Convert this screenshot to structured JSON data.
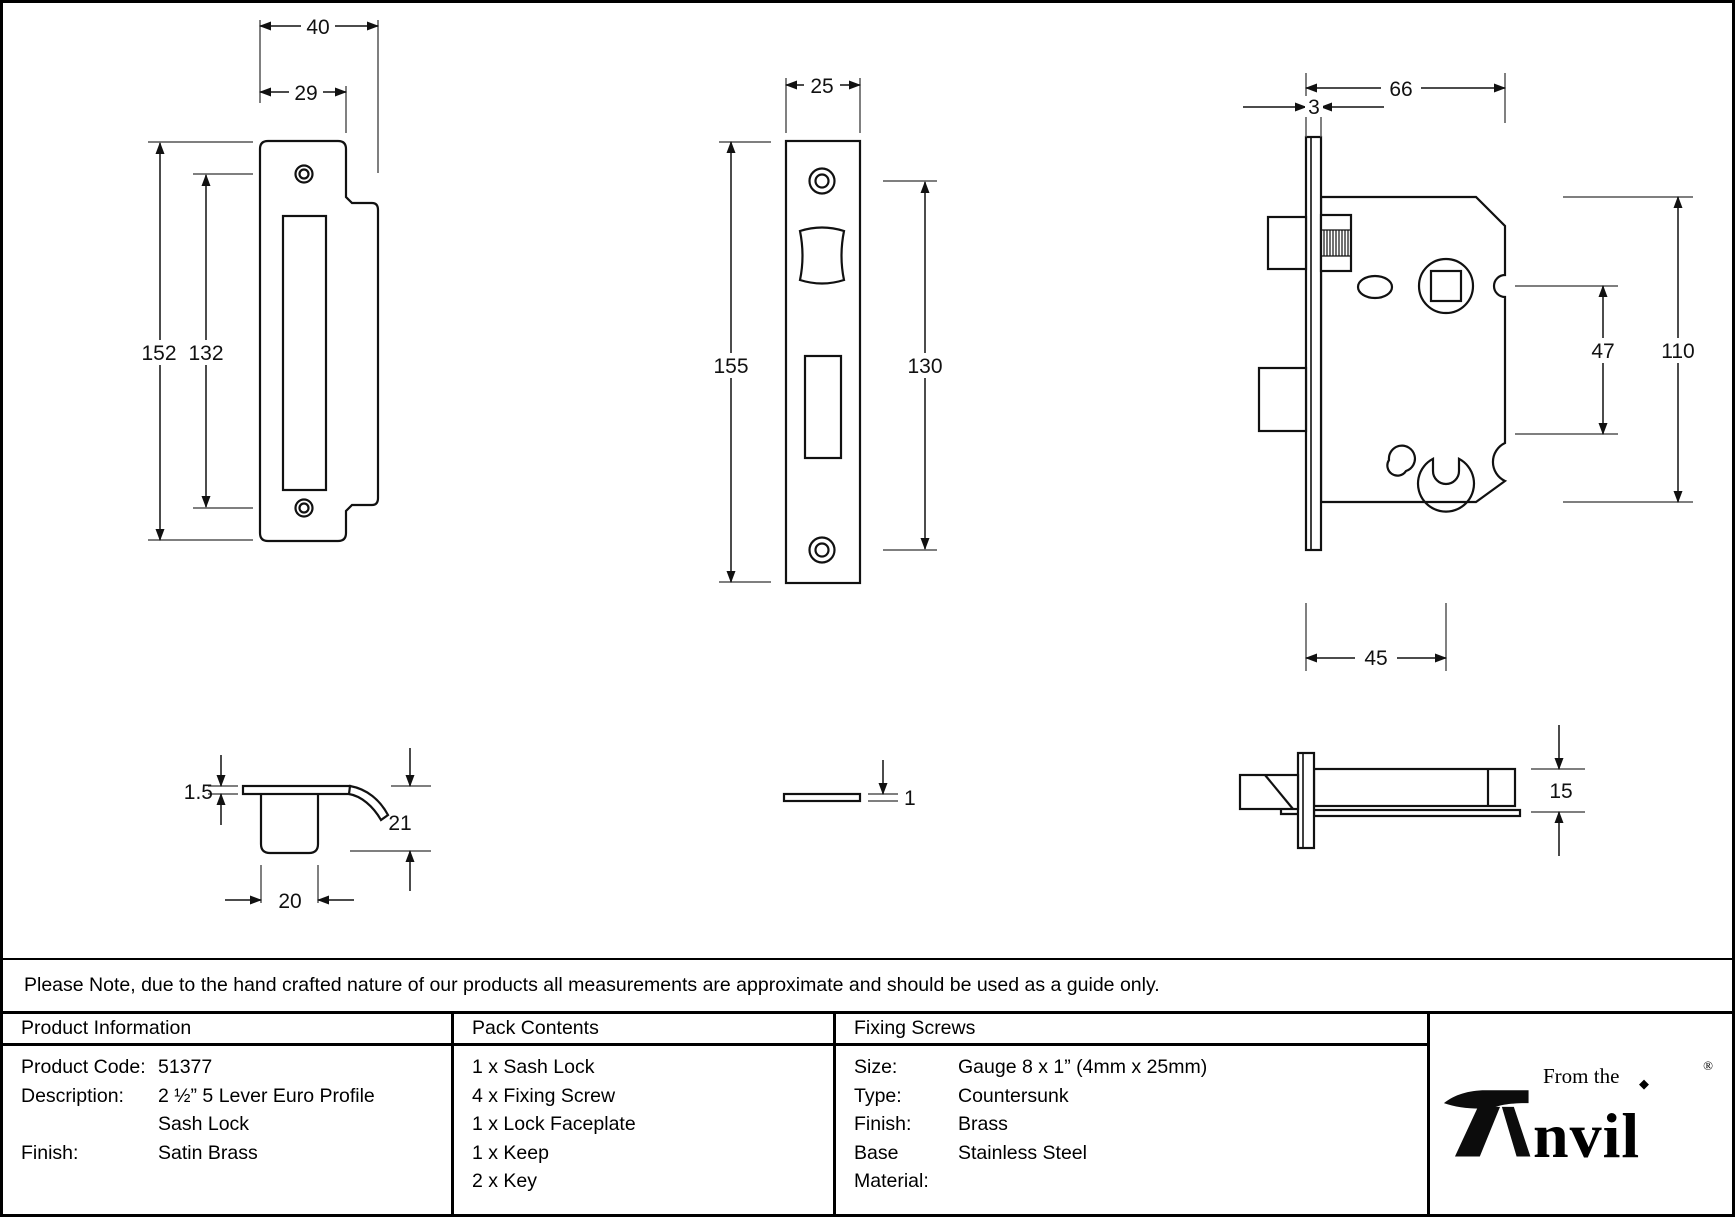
{
  "note": "Please Note, due to the hand crafted nature of our products all measurements are approximate and should be used as a guide only.",
  "drawings": {
    "keep_front": {
      "dim_width_overall": "40",
      "dim_width_inner": "29",
      "dim_height_overall": "152",
      "dim_height_inner": "132"
    },
    "faceplate_front": {
      "dim_width": "25",
      "dim_height_overall": "155",
      "dim_height_inner": "130"
    },
    "lock_body": {
      "dim_width": "66",
      "dim_faceplate_thickness": "3",
      "dim_height": "110",
      "dim_centres": "47",
      "dim_backset": "45"
    },
    "keep_profile": {
      "dim_plate_thickness": "1.5",
      "dim_depth": "21",
      "dim_box_width": "20"
    },
    "faceplate_edge": {
      "dim_thickness": "1"
    },
    "lock_side": {
      "dim_case_thickness": "15"
    }
  },
  "table": {
    "product_information": {
      "header": "Product Information",
      "rows": [
        {
          "label": "Product Code:",
          "value": "51377"
        },
        {
          "label": "Description:",
          "value": "2 ½” 5 Lever Euro Profile"
        },
        {
          "label": "",
          "value": "Sash Lock"
        },
        {
          "label": "Finish:",
          "value": "Satin Brass"
        }
      ]
    },
    "pack_contents": {
      "header": "Pack Contents",
      "items": [
        "1 x Sash Lock",
        "4 x Fixing Screw",
        "1 x Lock Faceplate",
        "1 x Keep",
        "2 x Key"
      ]
    },
    "fixing_screws": {
      "header": "Fixing Screws",
      "rows": [
        {
          "label": "Size:",
          "value": "Gauge 8 x 1” (4mm x 25mm)"
        },
        {
          "label": "Type:",
          "value": "Countersunk"
        },
        {
          "label": "Finish:",
          "value": "Brass"
        },
        {
          "label": "Base Material:",
          "value": "Stainless Steel"
        }
      ]
    }
  },
  "logo": {
    "prefix": "From the",
    "diamond": "◆",
    "brand_rest": "nvil",
    "registered": "®"
  }
}
